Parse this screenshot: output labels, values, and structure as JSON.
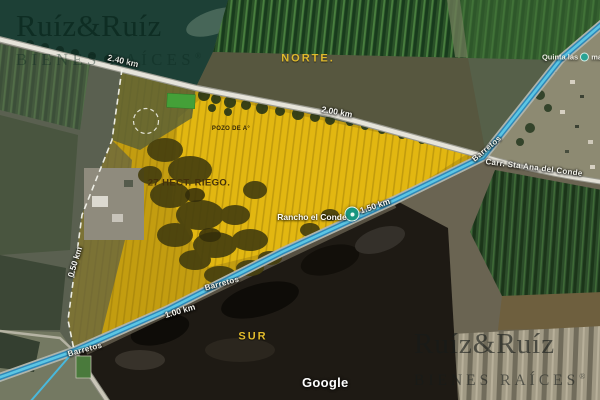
{
  "brand": {
    "name": "Ruíz&Ruíz",
    "tagline": "BIENES RAÍCES",
    "registered": "®"
  },
  "map": {
    "attribution": "Google",
    "cardinals": {
      "north": "NORTE.",
      "south": "SUR"
    },
    "property": {
      "area_label": "27 HECT. RIEGO.",
      "well_label": "POZO DE A°",
      "boundary_color": "#ffffff",
      "highlight_color": "#d9a90c"
    },
    "distances": {
      "northwest_road": "2.40 km",
      "north_road": "2.00 km",
      "highway_upper": "1.50 km",
      "highway_lower": "1.00 km",
      "west_side": "0.50 km"
    },
    "roads": {
      "highway_name_right": "Barretos",
      "highway_name_mid": "Barretos",
      "highway_name_southwest": "Barretos",
      "carr_name": "Carr. Sta Ana del Conde"
    },
    "places": {
      "rancho": "Rancho el Conde",
      "quinta_prefix": "Quinta las",
      "quinta_suffix": "ma"
    },
    "route_color": "#3fa8dc"
  }
}
